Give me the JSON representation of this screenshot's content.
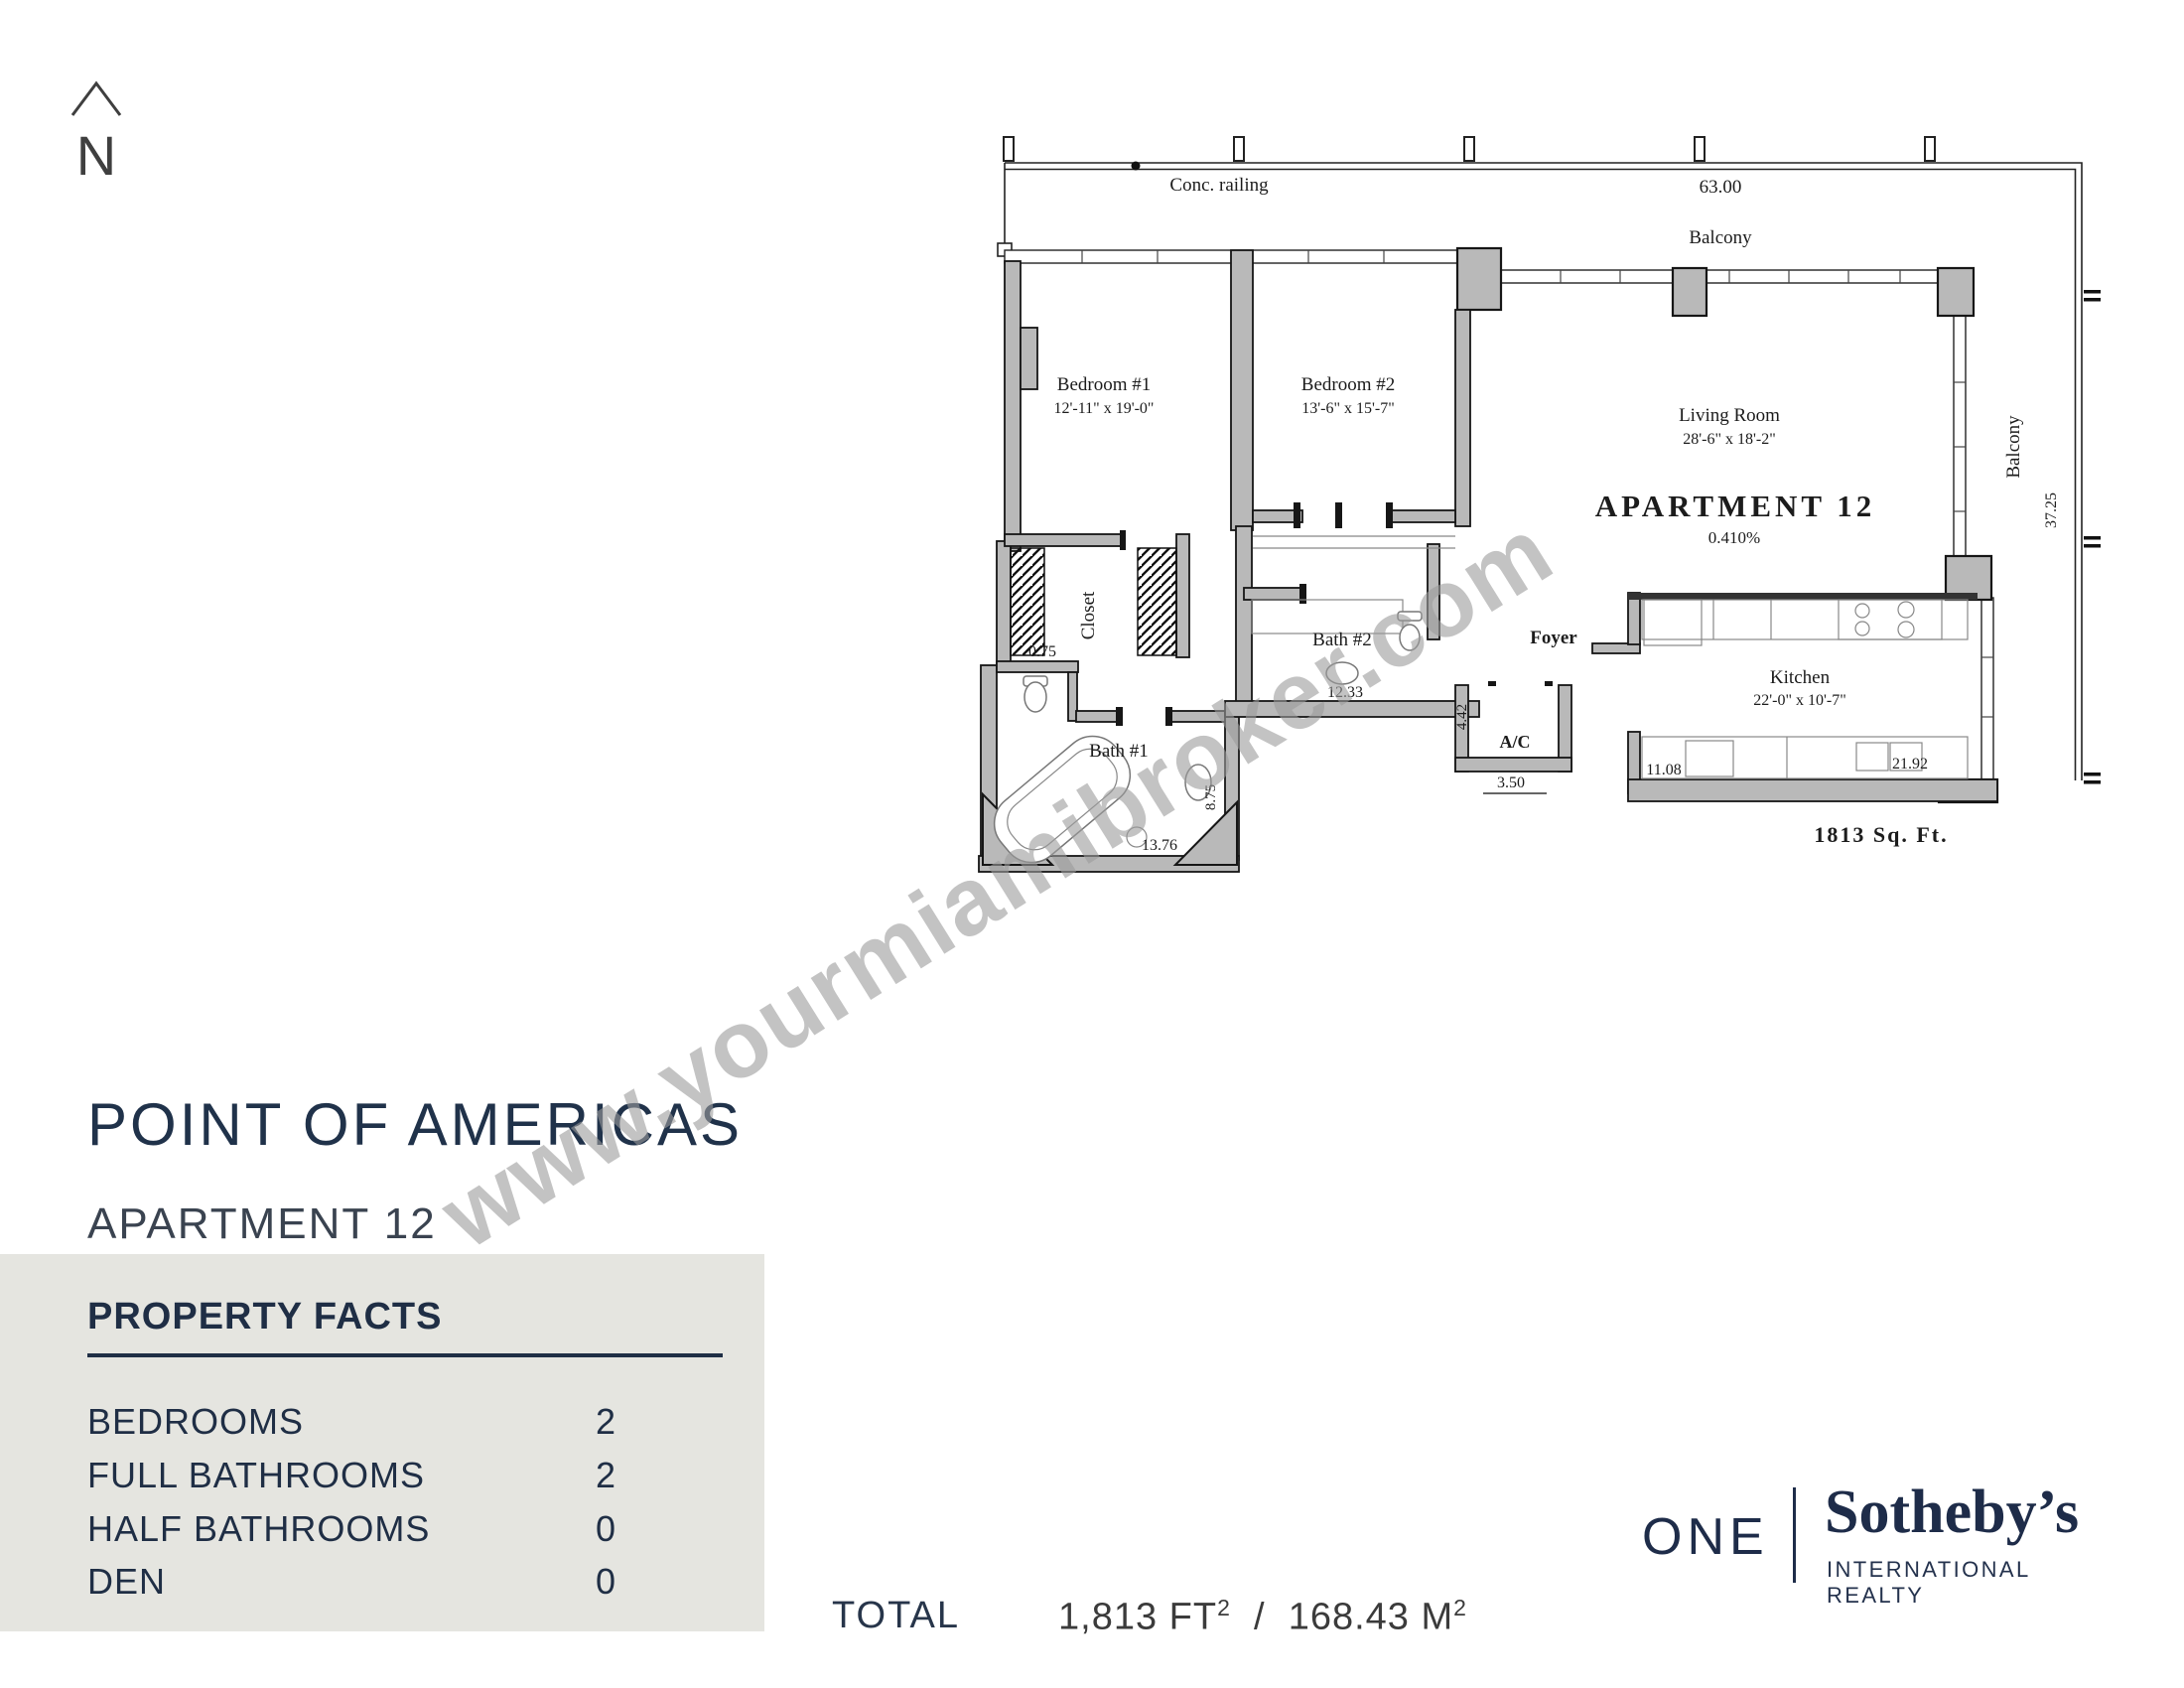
{
  "colors": {
    "accent_navy": "#1f2e45",
    "panel_bg": "#e5e5e0",
    "wall_gray": "#b9b9b9",
    "watermark_gray": "#9c9c9c",
    "plan_muted": "#8e8e8e"
  },
  "north_arrow": {
    "label": "N"
  },
  "watermark": {
    "text": "www.yourmiamibroker.com"
  },
  "listing": {
    "building": "POINT OF AMERICAS",
    "unit": "APARTMENT 12"
  },
  "floor_plan": {
    "conc_railing": "Conc. railing",
    "dim_width": "63.00",
    "balcony_top": "Balcony",
    "balcony_right": "Balcony",
    "dim_right": "37.25",
    "apartment": "APARTMENT  12",
    "percent": "0.410%",
    "sqft_note": "1813 Sq.  Ft.",
    "bedroom1": {
      "name": "Bedroom #1",
      "dims": "12'-11\" x 19'-0\""
    },
    "bedroom2": {
      "name": "Bedroom #2",
      "dims": "13'-6\" x 15'-7\""
    },
    "living": {
      "name": "Living Room",
      "dims": "28'-6\" x 18'-2\""
    },
    "kitchen": {
      "name": "Kitchen",
      "dims": "22'-0\" x 10'-7\""
    },
    "bath1": "Bath #1",
    "bath2": "Bath #2",
    "closet": "Closet",
    "foyer": "Foyer",
    "ac": "A/C",
    "d_closet": "0.75",
    "d_bath1_w": "13.76",
    "d_bath1_h": "8.75",
    "d_bath2": "12.33",
    "d_ac_h": "4.42",
    "d_ac_w": "3.50",
    "d_kitchen_l": "11.08",
    "d_kitchen_r": "21.92"
  },
  "property_facts": {
    "title": "PROPERTY FACTS",
    "rows": [
      {
        "label": "BEDROOMS",
        "value": "2"
      },
      {
        "label": "FULL BATHROOMS",
        "value": "2"
      },
      {
        "label": "HALF BATHROOMS",
        "value": "0"
      },
      {
        "label": "DEN",
        "value": "0"
      }
    ]
  },
  "total": {
    "label": "TOTAL",
    "sqft": "1,813 FT",
    "sqft_sup": "2",
    "separator": "/",
    "sqm": "168.43 M",
    "sqm_sup": "2"
  },
  "brand": {
    "one": "ONE",
    "name": "Sotheby’s",
    "tagline": "INTERNATIONAL REALTY"
  }
}
